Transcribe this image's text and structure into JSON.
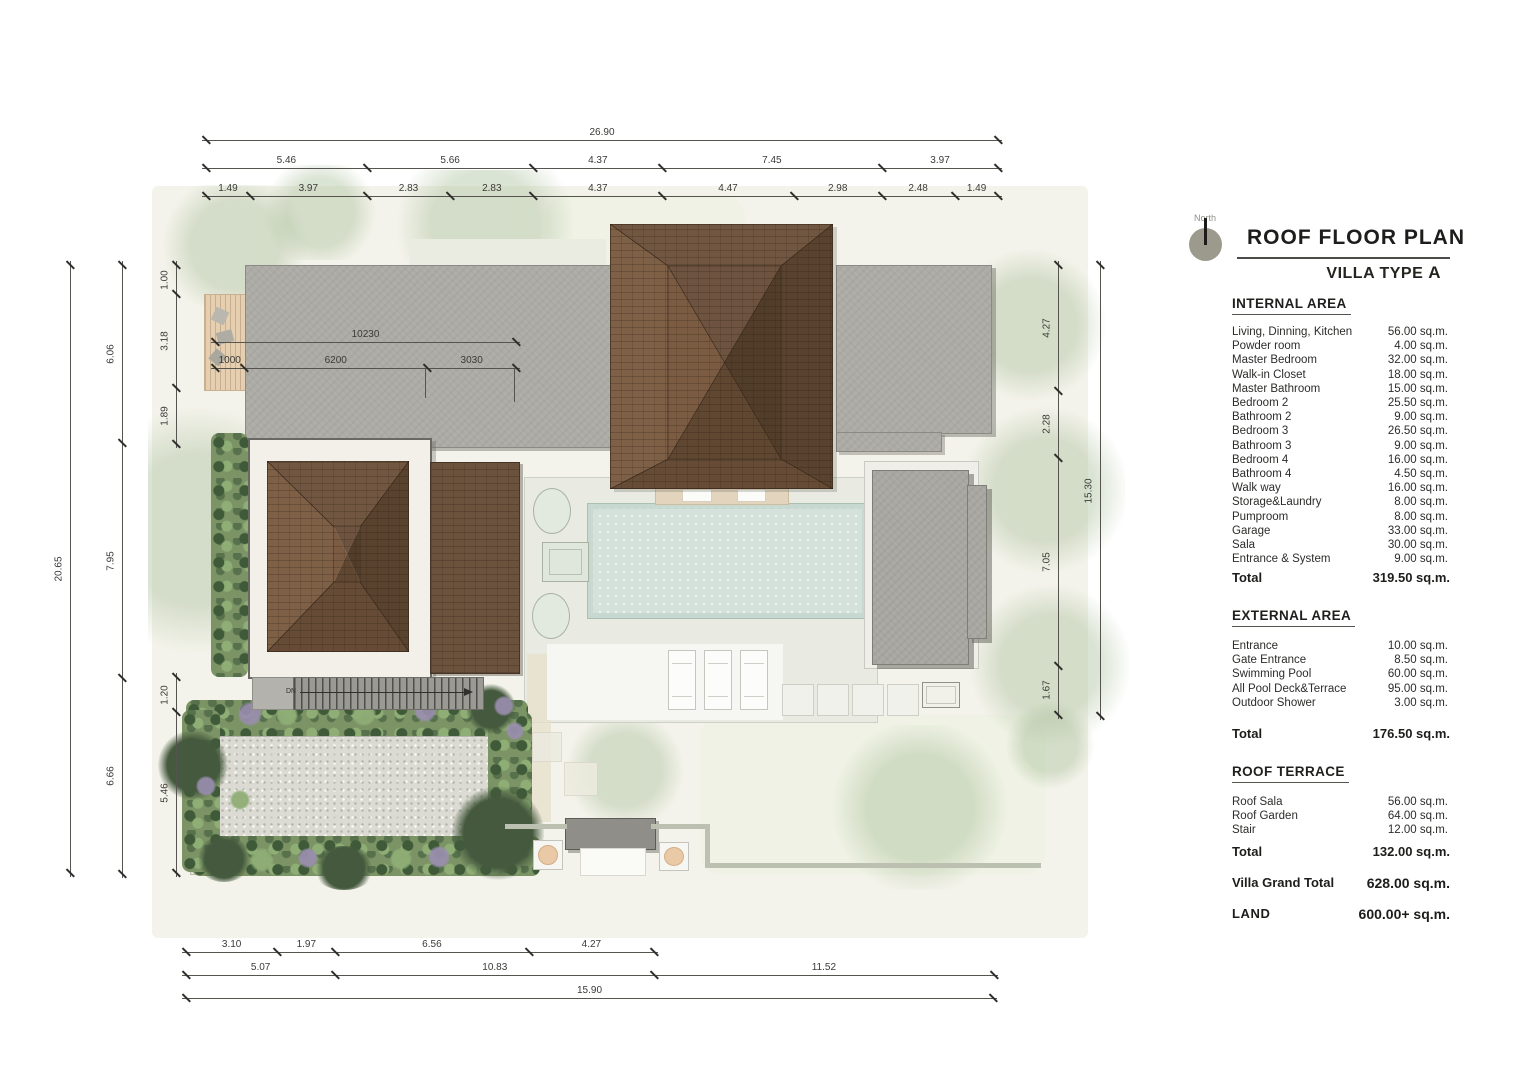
{
  "title_block": {
    "north_label": "North",
    "title": "ROOF FLOOR PLAN",
    "subtitle_prefix": "VILLA TYPE ",
    "subtitle_type": "A"
  },
  "areas": {
    "internal": {
      "heading": "INTERNAL AREA",
      "rows": [
        {
          "label": "Living, Dinning, Kitchen",
          "value": "56.00 sq.m."
        },
        {
          "label": "Powder room",
          "value": "4.00 sq.m."
        },
        {
          "label": "Master Bedroom",
          "value": "32.00 sq.m."
        },
        {
          "label": "Walk-in Closet",
          "value": "18.00 sq.m."
        },
        {
          "label": "Master Bathroom",
          "value": "15.00 sq.m."
        },
        {
          "label": "Bedroom 2",
          "value": "25.50 sq.m."
        },
        {
          "label": "Bathroom 2",
          "value": "9.00 sq.m."
        },
        {
          "label": "Bedroom 3",
          "value": "26.50 sq.m."
        },
        {
          "label": "Bathroom 3",
          "value": "9.00 sq.m."
        },
        {
          "label": "Bedroom 4",
          "value": "16.00 sq.m."
        },
        {
          "label": "Bathroom 4",
          "value": "4.50 sq.m."
        },
        {
          "label": "Walk way",
          "value": "16.00 sq.m."
        },
        {
          "label": "Storage&Laundry",
          "value": "8.00 sq.m."
        },
        {
          "label": "Pumproom",
          "value": "8.00 sq.m."
        },
        {
          "label": "Garage",
          "value": "33.00 sq.m."
        },
        {
          "label": "Sala",
          "value": "30.00 sq.m."
        },
        {
          "label": "Entrance & System",
          "value": "9.00 sq.m."
        }
      ],
      "total_label": "Total",
      "total_value": "319.50 sq.m."
    },
    "external": {
      "heading": "EXTERNAL AREA",
      "rows": [
        {
          "label": "Entrance",
          "value": "10.00 sq.m."
        },
        {
          "label": "Gate Entrance",
          "value": "8.50 sq.m."
        },
        {
          "label": "Swimming Pool",
          "value": "60.00 sq.m."
        },
        {
          "label": "All Pool Deck&Terrace",
          "value": "95.00 sq.m."
        },
        {
          "label": "Outdoor Shower",
          "value": "3.00 sq.m."
        }
      ],
      "total_label": "Total",
      "total_value": "176.50 sq.m."
    },
    "roof_terrace": {
      "heading": "ROOF TERRACE",
      "rows": [
        {
          "label": "Roof Sala",
          "value": "56.00 sq.m."
        },
        {
          "label": "Roof Garden",
          "value": "64.00 sq.m."
        },
        {
          "label": "Stair",
          "value": "12.00 sq.m."
        }
      ],
      "total_label": "Total",
      "total_value": "132.00 sq.m."
    },
    "grand_total": {
      "label": "Villa Grand Total",
      "value": "628.00 sq.m."
    },
    "land": {
      "label": "LAND",
      "value": "600.00+ sq.m."
    }
  },
  "dimensions": {
    "top": {
      "total": "26.90",
      "groups": [
        "5.46",
        "5.66",
        "4.37",
        "7.45",
        "3.97"
      ],
      "details": [
        "1.49",
        "3.97",
        "2.83",
        "2.83",
        "4.37",
        "4.47",
        "2.98",
        "2.48",
        "1.49"
      ]
    },
    "left": {
      "total": "20.65",
      "groups": [
        "6.06",
        "7.95",
        "6.66"
      ],
      "details": [
        "1.00",
        "3.18",
        "1.89",
        "1.20",
        "5.46"
      ]
    },
    "right": {
      "total": "15.30",
      "details": [
        "4.27",
        "2.28",
        "7.05",
        "1.67"
      ]
    },
    "bottom": {
      "details": [
        "3.10",
        "1.97",
        "6.56",
        "4.27"
      ],
      "groups": [
        "5.07",
        "10.83",
        "11.52"
      ],
      "total": "15.90"
    },
    "internal_mm": {
      "total": "10230",
      "details": [
        "1000",
        "6200",
        "3030"
      ]
    }
  },
  "plan_labels": {
    "stairs_dn": "DN"
  }
}
